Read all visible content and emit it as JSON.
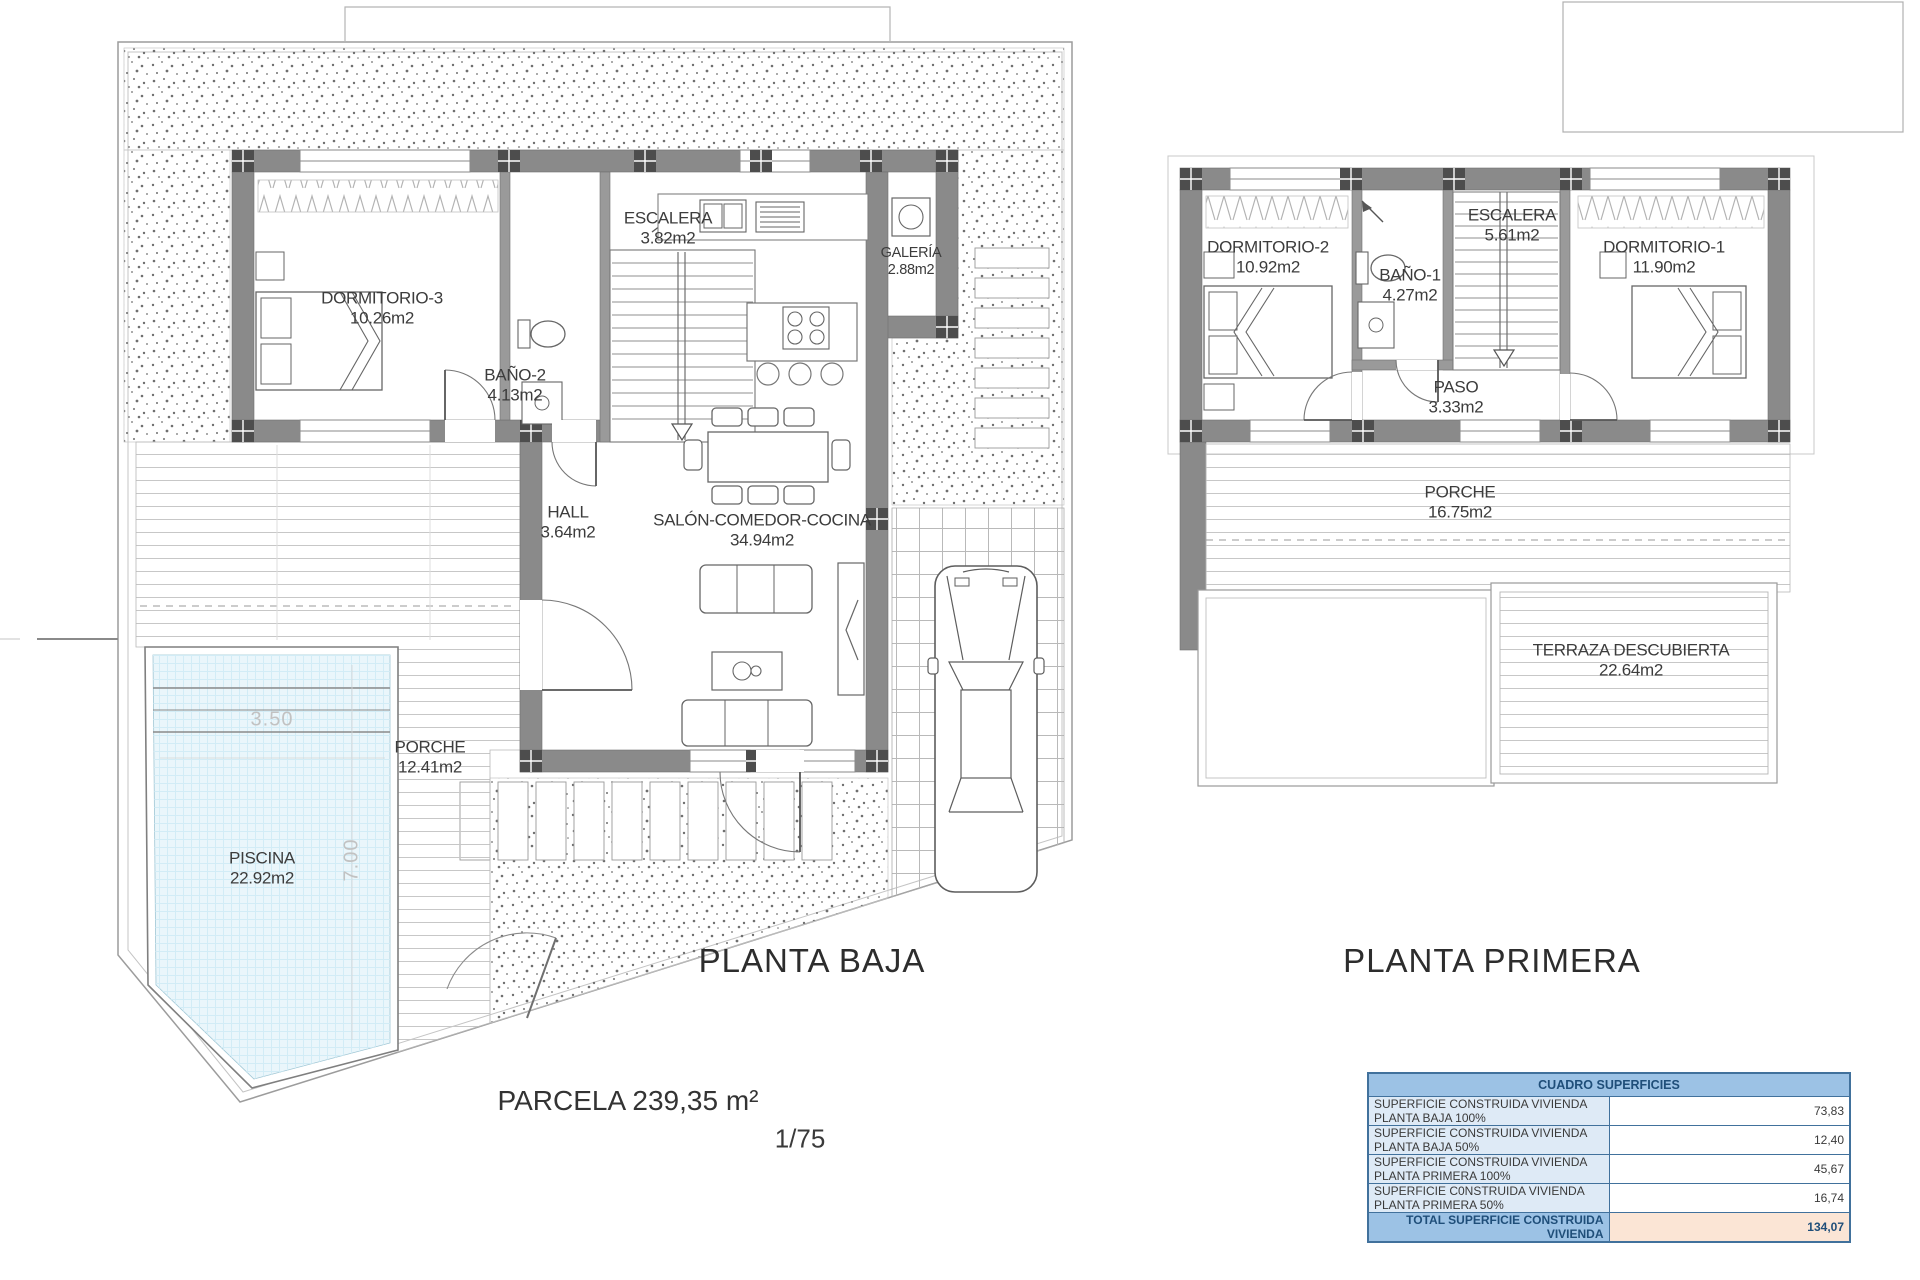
{
  "titles": {
    "ground": "PLANTA BAJA",
    "first": "PLANTA PRIMERA"
  },
  "annotations": {
    "parcel": "PARCELA 239,35 m²",
    "scale": "1/75"
  },
  "ground_floor": {
    "rooms": {
      "dormitorio3": {
        "name": "DORMITORIO-3",
        "area": "10.26m2"
      },
      "bano2": {
        "name": "BAÑO-2",
        "area": "4.13m2"
      },
      "escalera": {
        "name": "ESCALERA",
        "area": "3.82m2"
      },
      "galeria": {
        "name": "GALERÍA",
        "area": "2.88m2"
      },
      "hall": {
        "name": "HALL",
        "area": "3.64m2"
      },
      "salon": {
        "name": "SALÓN-COMEDOR-COCINA",
        "area": "34.94m2"
      },
      "porche": {
        "name": "PORCHE",
        "area": "12.41m2"
      },
      "piscina": {
        "name": "PISCINA",
        "area": "22.92m2"
      }
    },
    "pool_dims": {
      "width": "3.50",
      "length": "7.00"
    }
  },
  "first_floor": {
    "rooms": {
      "dormitorio2": {
        "name": "DORMITORIO-2",
        "area": "10.92m2"
      },
      "bano1": {
        "name": "BAÑO-1",
        "area": "4.27m2"
      },
      "escalera": {
        "name": "ESCALERA",
        "area": "5.61m2"
      },
      "dormitorio1": {
        "name": "DORMITORIO-1",
        "area": "11.90m2"
      },
      "paso": {
        "name": "PASO",
        "area": "3.33m2"
      },
      "porche": {
        "name": "PORCHE",
        "area": "16.75m2"
      },
      "terraza": {
        "name": "TERRAZA DESCUBIERTA",
        "area": "22.64m2"
      }
    }
  },
  "surface_table": {
    "title": "CUADRO SUPERFICIES",
    "rows": [
      {
        "label": "SUPERFICIE CONSTRUIDA VIVIENDA PLANTA BAJA 100%",
        "value": "73,83"
      },
      {
        "label": "SUPERFICIE CONSTRUIDA VIVIENDA PLANTA BAJA 50%",
        "value": "12,40"
      },
      {
        "label": "SUPERFICIE CONSTRUIDA VIVIENDA PLANTA PRIMERA 100%",
        "value": "45,67"
      },
      {
        "label": "SUPERFICIE C0NSTRUIDA VIVIENDA PLANTA PRIMERA 50%",
        "value": "16,74"
      }
    ],
    "total_label": "TOTAL SUPERFICIE CONSTRUIDA VIVIENDA",
    "total_value": "134,07"
  },
  "colors": {
    "wall_gray": "#8a8a8a",
    "pilaster_gray": "#4d4d4d",
    "pool_water": "#eaf6fb",
    "table_header_bg": "#9cc2e5",
    "table_row_bg": "#deeaf6",
    "table_total_value_bg": "#fbe5d5",
    "table_border": "#41719c"
  }
}
